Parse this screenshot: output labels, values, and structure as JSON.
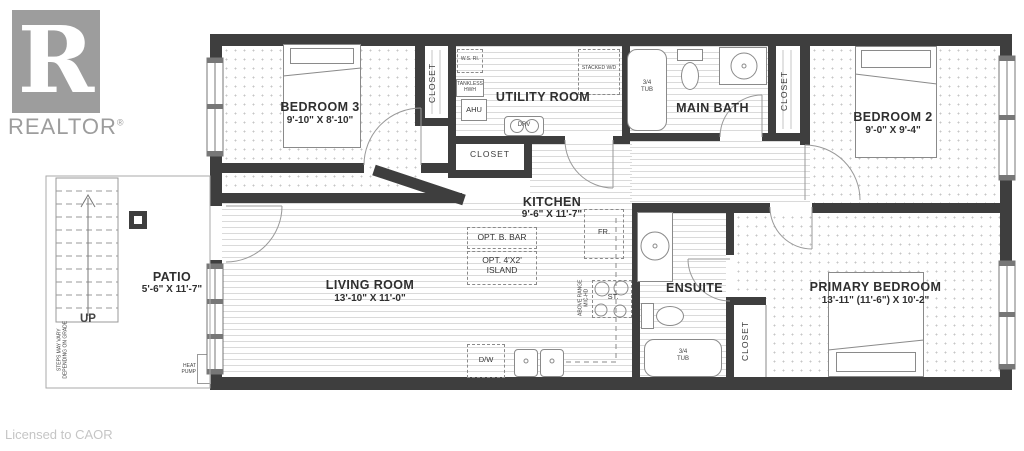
{
  "branding": {
    "logo_letter": "R",
    "logo_text": "REALTOR",
    "registered": "®",
    "license_note": "Licensed to CAOR"
  },
  "rooms": {
    "bedroom3": {
      "name": "BEDROOM 3",
      "dims": "9'-10\" X 8'-10\""
    },
    "utility": {
      "name": "UTILITY ROOM"
    },
    "main_bath": {
      "name": "MAIN BATH"
    },
    "bedroom2": {
      "name": "BEDROOM 2",
      "dims": "9'-0\" X 9'-4\""
    },
    "kitchen": {
      "name": "KITCHEN",
      "dims": "9'-6\" X 11'-7\""
    },
    "living": {
      "name": "LIVING ROOM",
      "dims": "13'-10\" X 11'-0\""
    },
    "ensuite": {
      "name": "ENSUITE"
    },
    "primary": {
      "name": "PRIMARY BEDROOM",
      "dims": "13'-11\" (11'-6\") X 10'-2\""
    },
    "patio": {
      "name": "PATIO",
      "dims": "5'-6\" X 11'-7\""
    }
  },
  "labels": {
    "closet": "CLOSET",
    "up": "UP",
    "steps_note": "STEPS MAY VARY\nDEPENDING ON GRADE",
    "heat_pump": "HEAT\nPUMP",
    "range_note": "ABOVE RANGE\nMIC-HD"
  },
  "fixtures": {
    "ws_ri": "W.S. RI.",
    "tankless": "TANKLESS\nHWH",
    "ahu": "AHU",
    "drv": "DRV",
    "stacked_wd": "STACKED W/D",
    "tub_main": "3/4\nTUB",
    "tub_ensuite": "3/4\nTUB",
    "fridge": "FR.",
    "stove": "ST.",
    "dishwasher": "D/W",
    "opt_bar": "OPT. B. BAR",
    "opt_island": "OPT. 4'X2'\nISLAND"
  }
}
